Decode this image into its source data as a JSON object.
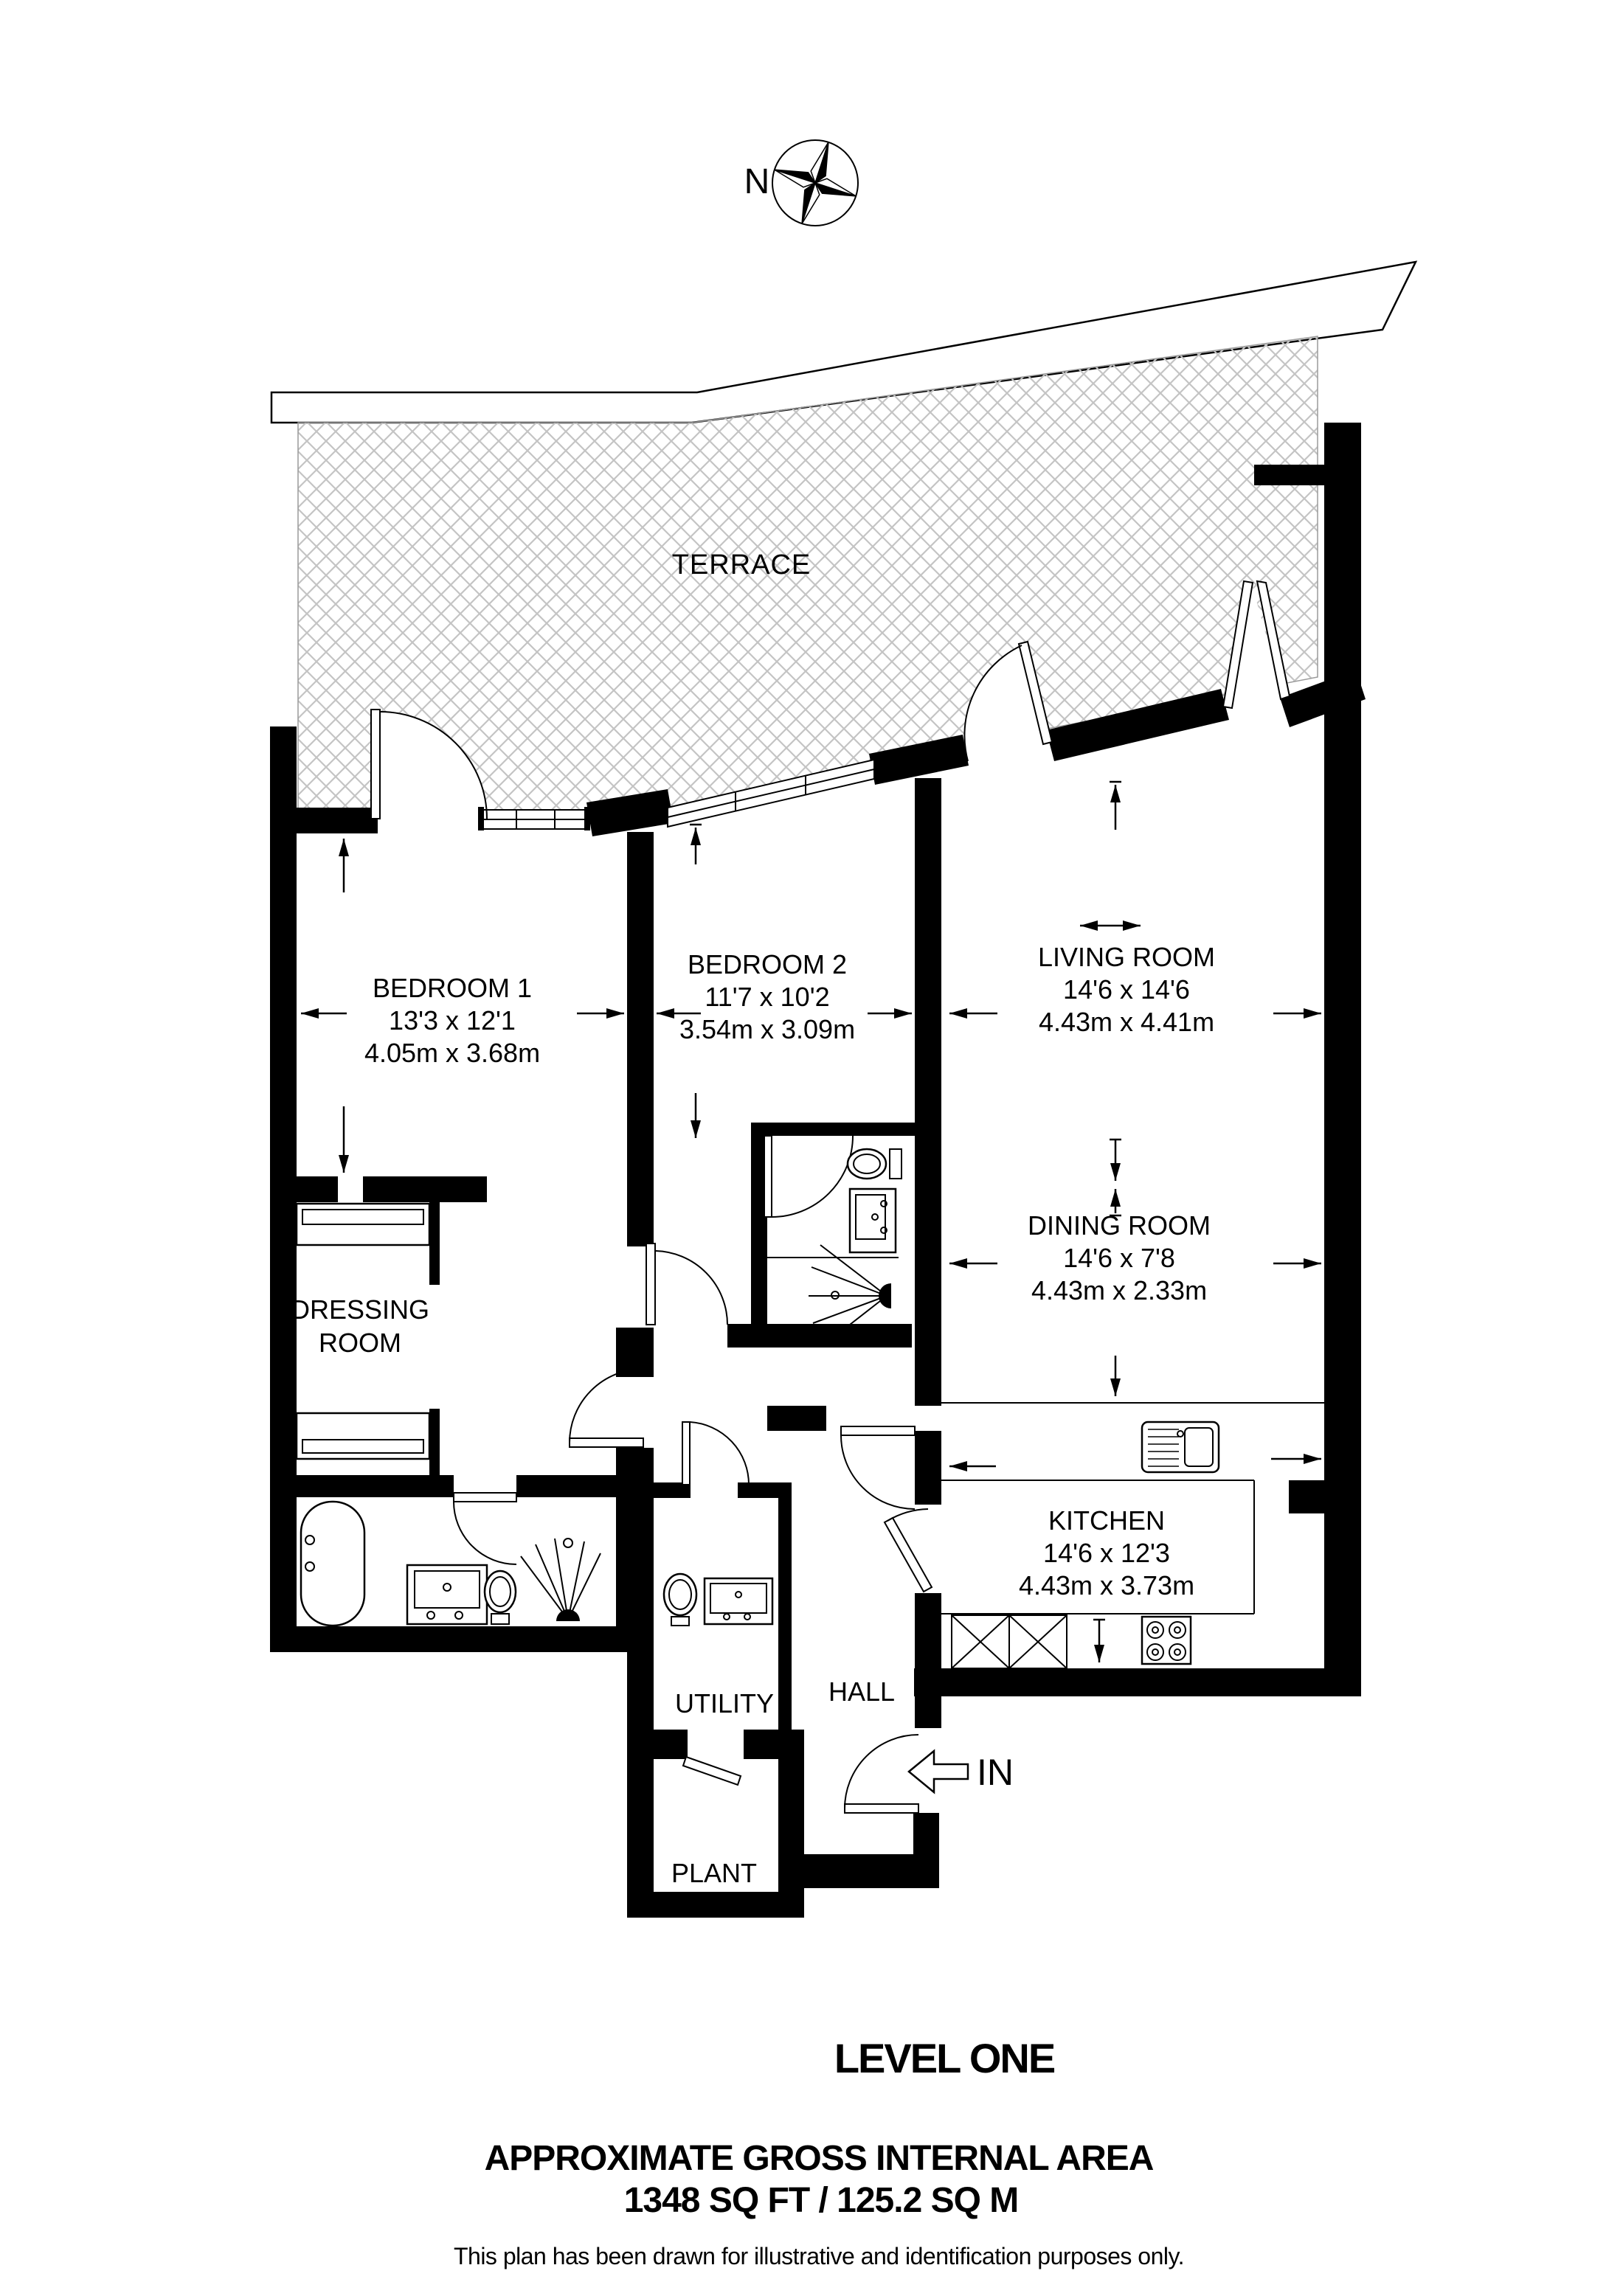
{
  "compass": {
    "north_label": "N"
  },
  "terrace": {
    "label": "TERRACE"
  },
  "rooms": {
    "bedroom1": {
      "name": "BEDROOM 1",
      "dims_ft": "13'3 x 12'1",
      "dims_m": "4.05m x 3.68m"
    },
    "bedroom2": {
      "name": "BEDROOM 2",
      "dims_ft": "11'7 x 10'2",
      "dims_m": "3.54m x 3.09m"
    },
    "living_room": {
      "name": "LIVING ROOM",
      "dims_ft": "14'6 x 14'6",
      "dims_m": "4.43m x 4.41m"
    },
    "dining_room": {
      "name": "DINING ROOM",
      "dims_ft": "14'6 x 7'8",
      "dims_m": "4.43m x 2.33m"
    },
    "kitchen": {
      "name": "KITCHEN",
      "dims_ft": "14'6 x 12'3",
      "dims_m": "4.43m x 3.73m"
    },
    "dressing_room": {
      "name_line1": "DRESSING",
      "name_line2": "ROOM"
    },
    "hall": {
      "name": "HALL"
    },
    "utility": {
      "name": "UTILITY"
    },
    "plant": {
      "name": "PLANT"
    }
  },
  "entrance": {
    "label": "IN"
  },
  "footer": {
    "level": "LEVEL ONE",
    "area_title": "APPROXIMATE GROSS INTERNAL AREA",
    "area_value": "1348 SQ FT / 125.2 SQ M",
    "disclaimer": "This plan has been drawn for illustrative and identification purposes only."
  },
  "colors": {
    "wall": "#000000",
    "hatch_line": "#c4c4c4",
    "background": "#ffffff"
  }
}
